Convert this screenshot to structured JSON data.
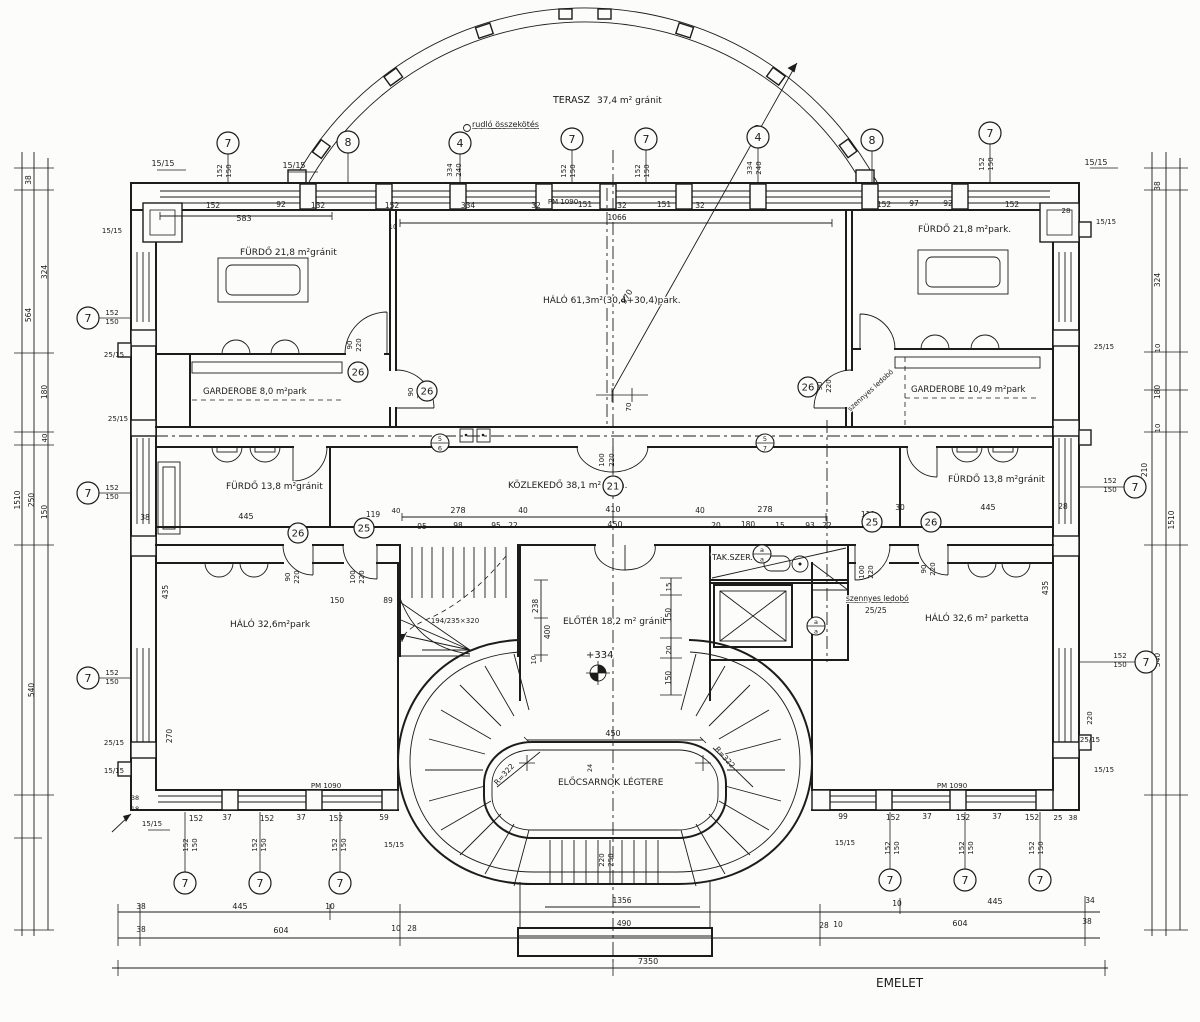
{
  "meta": {
    "sheet_label": "EMELET",
    "drawing_type": "floor plan"
  },
  "room_labels": [
    {
      "t": "TERASZ",
      "x": 553,
      "y": 103,
      "fs": 9.5
    },
    {
      "t": "37,4 m² gránit",
      "x": 597,
      "y": 103,
      "fs": 9
    },
    {
      "t": "FÜRDŐ  21,8 m²gránit",
      "x": 240,
      "y": 255,
      "fs": 9
    },
    {
      "t": "FÜRDŐ  21,8 m²park.",
      "x": 918,
      "y": 232,
      "fs": 9
    },
    {
      "t": "HÁLÓ  61,3m²(30,4+30,4)park.",
      "x": 543,
      "y": 303,
      "fs": 9
    },
    {
      "t": "GARDEROBE  8,0 m²park",
      "x": 203,
      "y": 394,
      "fs": 8.5
    },
    {
      "t": "GARDEROBE  10,49 m²park",
      "x": 911,
      "y": 392,
      "fs": 8.5
    },
    {
      "t": "FÜRDŐ  13,8 m²gránit",
      "x": 226,
      "y": 489,
      "fs": 9
    },
    {
      "t": "KÖZLEKEDŐ  38,1 m² grán.",
      "x": 508,
      "y": 488,
      "fs": 9
    },
    {
      "t": "FÜRDŐ  13,8 m²gránit",
      "x": 948,
      "y": 482,
      "fs": 9
    },
    {
      "t": "HÁLÓ  32,6m²park",
      "x": 230,
      "y": 627,
      "fs": 9
    },
    {
      "t": "ELŐTÉR  18,2 m² gránit",
      "x": 563,
      "y": 624,
      "fs": 9
    },
    {
      "t": "HÁLÓ  32,6 m² parketta",
      "x": 925,
      "y": 621,
      "fs": 9
    },
    {
      "t": "ELŐCSARNOK LÉGTERE",
      "x": 558,
      "y": 785,
      "fs": 9
    },
    {
      "t": "TAK.SZER.",
      "x": 712,
      "y": 560,
      "fs": 8
    },
    {
      "t": "EMELET",
      "x": 876,
      "y": 987,
      "fs": 12
    },
    {
      "t": "szennyes ledobó",
      "x": 846,
      "y": 601,
      "fs": 7.5,
      "u": 1
    },
    {
      "t": "25/25",
      "x": 865,
      "y": 613,
      "fs": 7.5
    },
    {
      "t": "rudló összekötés",
      "x": 472,
      "y": 127,
      "fs": 8,
      "u": 1
    },
    {
      "t": "+334",
      "x": 586,
      "y": 658,
      "fs": 10
    },
    {
      "t": "szennyes ledobó",
      "x": 872,
      "y": 392,
      "fs": 7,
      "r": -42,
      "a": "middle"
    }
  ],
  "dimensions": [
    {
      "t": "15/15",
      "x": 163,
      "y": 166
    },
    {
      "t": "15/15",
      "x": 294,
      "y": 168
    },
    {
      "t": "15/15",
      "x": 1096,
      "y": 165
    },
    {
      "t": "152",
      "x": 222,
      "y": 171,
      "r": -90,
      "fs": 7
    },
    {
      "t": "150",
      "x": 231,
      "y": 171,
      "r": -90,
      "fs": 7
    },
    {
      "t": "334",
      "x": 452,
      "y": 170,
      "r": -90,
      "fs": 7
    },
    {
      "t": "240",
      "x": 461,
      "y": 170,
      "r": -90,
      "fs": 7
    },
    {
      "t": "152",
      "x": 566,
      "y": 171,
      "r": -90,
      "fs": 7
    },
    {
      "t": "150",
      "x": 575,
      "y": 171,
      "r": -90,
      "fs": 7
    },
    {
      "t": "152",
      "x": 640,
      "y": 171,
      "r": -90,
      "fs": 7
    },
    {
      "t": "150",
      "x": 649,
      "y": 171,
      "r": -90,
      "fs": 7
    },
    {
      "t": "334",
      "x": 752,
      "y": 168,
      "r": -90,
      "fs": 7
    },
    {
      "t": "240",
      "x": 761,
      "y": 168,
      "r": -90,
      "fs": 7
    },
    {
      "t": "152",
      "x": 984,
      "y": 164,
      "r": -90,
      "fs": 7
    },
    {
      "t": "150",
      "x": 993,
      "y": 164,
      "r": -90,
      "fs": 7
    },
    {
      "t": "152",
      "x": 213,
      "y": 208,
      "fs": 7.5
    },
    {
      "t": "92",
      "x": 281,
      "y": 207,
      "fs": 7.5
    },
    {
      "t": "132",
      "x": 318,
      "y": 208,
      "fs": 7.5
    },
    {
      "t": "152",
      "x": 392,
      "y": 208,
      "fs": 7.5
    },
    {
      "t": "334",
      "x": 468,
      "y": 208,
      "fs": 7.5
    },
    {
      "t": "32",
      "x": 536,
      "y": 208,
      "fs": 7.5
    },
    {
      "t": "PM 1090",
      "x": 563,
      "y": 204,
      "fs": 7
    },
    {
      "t": "151",
      "x": 585,
      "y": 207,
      "fs": 7.5
    },
    {
      "t": "32",
      "x": 622,
      "y": 208,
      "fs": 7.5
    },
    {
      "t": "151",
      "x": 664,
      "y": 207,
      "fs": 7.5
    },
    {
      "t": "32",
      "x": 700,
      "y": 208,
      "fs": 7.5
    },
    {
      "t": "152",
      "x": 884,
      "y": 207,
      "fs": 7.5
    },
    {
      "t": "97",
      "x": 914,
      "y": 206,
      "fs": 7.5
    },
    {
      "t": "92",
      "x": 948,
      "y": 206,
      "fs": 7.5
    },
    {
      "t": "152",
      "x": 1012,
      "y": 207,
      "fs": 7.5
    },
    {
      "t": "28",
      "x": 1066,
      "y": 213,
      "fs": 7
    },
    {
      "t": "583",
      "x": 244,
      "y": 221
    },
    {
      "t": "10",
      "x": 393,
      "y": 229,
      "fs": 7
    },
    {
      "t": "1066",
      "x": 617,
      "y": 220,
      "fs": 7.5
    },
    {
      "t": "970",
      "x": 629,
      "y": 298,
      "r": -60
    },
    {
      "t": "70",
      "x": 631,
      "y": 407,
      "r": -90,
      "fs": 7
    },
    {
      "t": "90",
      "x": 352,
      "y": 345,
      "r": -90,
      "fs": 7
    },
    {
      "t": "220",
      "x": 361,
      "y": 345,
      "r": -90,
      "fs": 7
    },
    {
      "t": "90",
      "x": 413,
      "y": 392,
      "r": -90,
      "fs": 7
    },
    {
      "t": "220",
      "x": 422,
      "y": 392,
      "r": -90,
      "fs": 7
    },
    {
      "t": "90",
      "x": 822,
      "y": 386,
      "r": -90,
      "fs": 7
    },
    {
      "t": "220",
      "x": 831,
      "y": 386,
      "r": -90,
      "fs": 7
    },
    {
      "t": "100",
      "x": 604,
      "y": 460,
      "r": -90,
      "fs": 7
    },
    {
      "t": "220",
      "x": 614,
      "y": 460,
      "r": -90,
      "fs": 7
    },
    {
      "t": "278",
      "x": 458,
      "y": 513
    },
    {
      "t": "40",
      "x": 523,
      "y": 513,
      "fs": 7.5
    },
    {
      "t": "410",
      "x": 613,
      "y": 512
    },
    {
      "t": "40",
      "x": 700,
      "y": 513,
      "fs": 7.5
    },
    {
      "t": "278",
      "x": 765,
      "y": 512
    },
    {
      "t": "95",
      "x": 422,
      "y": 529,
      "fs": 7.5
    },
    {
      "t": "98",
      "x": 458,
      "y": 528,
      "fs": 7.5
    },
    {
      "t": "95",
      "x": 496,
      "y": 528,
      "fs": 7.5
    },
    {
      "t": "22",
      "x": 513,
      "y": 528,
      "fs": 7.5
    },
    {
      "t": "450",
      "x": 615,
      "y": 527
    },
    {
      "t": "20",
      "x": 716,
      "y": 528,
      "fs": 7.5
    },
    {
      "t": "180",
      "x": 748,
      "y": 527,
      "fs": 7.5
    },
    {
      "t": "15",
      "x": 780,
      "y": 528,
      "fs": 7.5
    },
    {
      "t": "93",
      "x": 810,
      "y": 528,
      "fs": 7.5
    },
    {
      "t": "22",
      "x": 827,
      "y": 528,
      "fs": 7.5
    },
    {
      "t": "38",
      "x": 145,
      "y": 520,
      "fs": 7.5
    },
    {
      "t": "445",
      "x": 246,
      "y": 519
    },
    {
      "t": "119",
      "x": 373,
      "y": 517,
      "fs": 7.5
    },
    {
      "t": "40",
      "x": 396,
      "y": 513,
      "fs": 7
    },
    {
      "t": "30",
      "x": 900,
      "y": 510,
      "fs": 7.5
    },
    {
      "t": "445",
      "x": 988,
      "y": 510
    },
    {
      "t": "119",
      "x": 868,
      "y": 517,
      "fs": 7.5
    },
    {
      "t": "28",
      "x": 1063,
      "y": 509,
      "fs": 7.5
    },
    {
      "t": "152",
      "x": 112,
      "y": 315,
      "fs": 7
    },
    {
      "t": "150",
      "x": 112,
      "y": 324,
      "fs": 7
    },
    {
      "t": "152",
      "x": 112,
      "y": 490,
      "fs": 7
    },
    {
      "t": "150",
      "x": 112,
      "y": 499,
      "fs": 7
    },
    {
      "t": "152",
      "x": 112,
      "y": 675,
      "fs": 7
    },
    {
      "t": "150",
      "x": 112,
      "y": 684,
      "fs": 7
    },
    {
      "t": "152",
      "x": 1110,
      "y": 483,
      "fs": 7
    },
    {
      "t": "150",
      "x": 1110,
      "y": 492,
      "fs": 7
    },
    {
      "t": "152",
      "x": 1120,
      "y": 658,
      "fs": 7
    },
    {
      "t": "150",
      "x": 1120,
      "y": 667,
      "fs": 7
    },
    {
      "t": "15/15",
      "x": 112,
      "y": 233,
      "fs": 7
    },
    {
      "t": "25/15",
      "x": 114,
      "y": 357,
      "fs": 7
    },
    {
      "t": "25/15",
      "x": 118,
      "y": 421,
      "fs": 7
    },
    {
      "t": "25/15",
      "x": 114,
      "y": 745,
      "fs": 7
    },
    {
      "t": "15/15",
      "x": 114,
      "y": 773,
      "fs": 7
    },
    {
      "t": "15/15",
      "x": 1106,
      "y": 224,
      "fs": 7
    },
    {
      "t": "25/15",
      "x": 1104,
      "y": 349,
      "fs": 7
    },
    {
      "t": "25/15",
      "x": 1090,
      "y": 742,
      "fs": 7
    },
    {
      "t": "220",
      "x": 1092,
      "y": 718,
      "r": -90,
      "fs": 7
    },
    {
      "t": "15/15",
      "x": 1104,
      "y": 772,
      "fs": 7
    },
    {
      "t": "38",
      "x": 31,
      "y": 180,
      "r": -90,
      "fs": 7.5
    },
    {
      "t": "324",
      "x": 47,
      "y": 272,
      "r": -90,
      "fs": 7.5
    },
    {
      "t": "564",
      "x": 31,
      "y": 315,
      "r": -90,
      "fs": 7.5
    },
    {
      "t": "180",
      "x": 47,
      "y": 392,
      "r": -90,
      "fs": 7.5
    },
    {
      "t": "40",
      "x": 47,
      "y": 438,
      "r": -90,
      "fs": 7
    },
    {
      "t": "1510",
      "x": 20,
      "y": 500,
      "r": -90,
      "fs": 7.5
    },
    {
      "t": "250",
      "x": 34,
      "y": 500,
      "r": -90,
      "fs": 7.5
    },
    {
      "t": "150",
      "x": 47,
      "y": 512,
      "r": -90,
      "fs": 7.5
    },
    {
      "t": "540",
      "x": 34,
      "y": 690,
      "r": -90,
      "fs": 7.5
    },
    {
      "t": "38",
      "x": 1160,
      "y": 186,
      "r": -90,
      "fs": 7.5
    },
    {
      "t": "324",
      "x": 1160,
      "y": 280,
      "r": -90,
      "fs": 7.5
    },
    {
      "t": "10",
      "x": 1160,
      "y": 348,
      "r": -90,
      "fs": 7
    },
    {
      "t": "180",
      "x": 1160,
      "y": 392,
      "r": -90,
      "fs": 7.5
    },
    {
      "t": "10",
      "x": 1160,
      "y": 428,
      "r": -90,
      "fs": 7
    },
    {
      "t": "210",
      "x": 1147,
      "y": 470,
      "r": -90,
      "fs": 7.5
    },
    {
      "t": "1510",
      "x": 1174,
      "y": 520,
      "r": -90,
      "fs": 7.5
    },
    {
      "t": "540",
      "x": 1160,
      "y": 660,
      "r": -90,
      "fs": 7.5
    },
    {
      "t": "435",
      "x": 168,
      "y": 592,
      "r": -90,
      "fs": 7.5
    },
    {
      "t": "270",
      "x": 172,
      "y": 736,
      "r": -90,
      "fs": 7.5
    },
    {
      "t": "435",
      "x": 1048,
      "y": 588,
      "r": -90,
      "fs": 7.5
    },
    {
      "t": "90",
      "x": 290,
      "y": 577,
      "r": -90,
      "fs": 7
    },
    {
      "t": "220",
      "x": 299,
      "y": 577,
      "r": -90,
      "fs": 7
    },
    {
      "t": "100",
      "x": 355,
      "y": 577,
      "r": -90,
      "fs": 7
    },
    {
      "t": "220",
      "x": 364,
      "y": 577,
      "r": -90,
      "fs": 7
    },
    {
      "t": "100",
      "x": 864,
      "y": 572,
      "r": -90,
      "fs": 7
    },
    {
      "t": "220",
      "x": 873,
      "y": 572,
      "r": -90,
      "fs": 7
    },
    {
      "t": "90",
      "x": 926,
      "y": 569,
      "r": -90,
      "fs": 7
    },
    {
      "t": "220",
      "x": 935,
      "y": 569,
      "r": -90,
      "fs": 7
    },
    {
      "t": "150",
      "x": 337,
      "y": 603,
      "fs": 7.5
    },
    {
      "t": "89",
      "x": 388,
      "y": 603,
      "fs": 7.5
    },
    {
      "t": "238",
      "x": 538,
      "y": 606,
      "r": -90,
      "fs": 7.5
    },
    {
      "t": "400",
      "x": 550,
      "y": 632,
      "r": -90,
      "fs": 7.5
    },
    {
      "t": "10",
      "x": 536,
      "y": 660,
      "r": -90,
      "fs": 7
    },
    {
      "t": "15",
      "x": 671,
      "y": 587,
      "r": -90,
      "fs": 7
    },
    {
      "t": "150",
      "x": 671,
      "y": 615,
      "r": -90,
      "fs": 7.5
    },
    {
      "t": "20",
      "x": 671,
      "y": 650,
      "r": -90,
      "fs": 7
    },
    {
      "t": "150",
      "x": 671,
      "y": 678,
      "r": -90,
      "fs": 7.5
    },
    {
      "t": "194/235×320",
      "x": 455,
      "y": 623,
      "fs": 7
    },
    {
      "t": "450",
      "x": 613,
      "y": 736
    },
    {
      "t": "24",
      "x": 592,
      "y": 768,
      "r": -90,
      "fs": 6.5
    },
    {
      "t": "R=322",
      "x": 506,
      "y": 776,
      "r": -48,
      "fs": 7.5
    },
    {
      "t": "R=322",
      "x": 723,
      "y": 759,
      "r": 48,
      "fs": 7.5
    },
    {
      "t": "PM 1090",
      "x": 326,
      "y": 788,
      "fs": 7
    },
    {
      "t": "PM 1090",
      "x": 952,
      "y": 788,
      "fs": 7
    },
    {
      "t": "152",
      "x": 196,
      "y": 821,
      "fs": 7.5
    },
    {
      "t": "37",
      "x": 227,
      "y": 820,
      "fs": 7.5
    },
    {
      "t": "152",
      "x": 267,
      "y": 821,
      "fs": 7.5
    },
    {
      "t": "37",
      "x": 301,
      "y": 820,
      "fs": 7.5
    },
    {
      "t": "152",
      "x": 336,
      "y": 821,
      "fs": 7.5
    },
    {
      "t": "59",
      "x": 384,
      "y": 820,
      "fs": 7.5
    },
    {
      "t": "15/15",
      "x": 394,
      "y": 847,
      "fs": 7
    },
    {
      "t": "152",
      "x": 188,
      "y": 845,
      "r": -90,
      "fs": 7
    },
    {
      "t": "150",
      "x": 197,
      "y": 845,
      "r": -90,
      "fs": 7
    },
    {
      "t": "152",
      "x": 257,
      "y": 845,
      "r": -90,
      "fs": 7
    },
    {
      "t": "150",
      "x": 266,
      "y": 845,
      "r": -90,
      "fs": 7
    },
    {
      "t": "152",
      "x": 337,
      "y": 845,
      "r": -90,
      "fs": 7
    },
    {
      "t": "150",
      "x": 346,
      "y": 845,
      "r": -90,
      "fs": 7
    },
    {
      "t": "99",
      "x": 843,
      "y": 819,
      "fs": 7.5
    },
    {
      "t": "152",
      "x": 893,
      "y": 820,
      "fs": 7.5
    },
    {
      "t": "37",
      "x": 927,
      "y": 819,
      "fs": 7.5
    },
    {
      "t": "152",
      "x": 963,
      "y": 820,
      "fs": 7.5
    },
    {
      "t": "37",
      "x": 997,
      "y": 819,
      "fs": 7.5
    },
    {
      "t": "152",
      "x": 1032,
      "y": 820,
      "fs": 7.5
    },
    {
      "t": "25",
      "x": 1058,
      "y": 820,
      "fs": 7
    },
    {
      "t": "38",
      "x": 1073,
      "y": 820,
      "fs": 7
    },
    {
      "t": "15/15",
      "x": 845,
      "y": 845,
      "fs": 7
    },
    {
      "t": "152",
      "x": 890,
      "y": 848,
      "r": -90,
      "fs": 7
    },
    {
      "t": "150",
      "x": 899,
      "y": 848,
      "r": -90,
      "fs": 7
    },
    {
      "t": "152",
      "x": 964,
      "y": 848,
      "r": -90,
      "fs": 7
    },
    {
      "t": "150",
      "x": 973,
      "y": 848,
      "r": -90,
      "fs": 7
    },
    {
      "t": "152",
      "x": 1034,
      "y": 848,
      "r": -90,
      "fs": 7
    },
    {
      "t": "150",
      "x": 1043,
      "y": 848,
      "r": -90,
      "fs": 7
    },
    {
      "t": "38",
      "x": 135,
      "y": 800,
      "fs": 6.5
    },
    {
      "t": "18",
      "x": 135,
      "y": 811,
      "fs": 6.5
    },
    {
      "t": "15/15",
      "x": 152,
      "y": 826,
      "fs": 7
    },
    {
      "t": "38",
      "x": 141,
      "y": 909,
      "fs": 7.5
    },
    {
      "t": "445",
      "x": 240,
      "y": 909
    },
    {
      "t": "10",
      "x": 330,
      "y": 909,
      "fs": 7.5
    },
    {
      "t": "10",
      "x": 897,
      "y": 906,
      "fs": 7.5
    },
    {
      "t": "445",
      "x": 995,
      "y": 904
    },
    {
      "t": "34",
      "x": 1090,
      "y": 903,
      "fs": 7.5
    },
    {
      "t": "38",
      "x": 141,
      "y": 932,
      "fs": 7.5
    },
    {
      "t": "604",
      "x": 281,
      "y": 933
    },
    {
      "t": "10",
      "x": 396,
      "y": 931,
      "fs": 7.5
    },
    {
      "t": "28",
      "x": 412,
      "y": 931,
      "fs": 7.5
    },
    {
      "t": "28",
      "x": 824,
      "y": 928,
      "fs": 7.5
    },
    {
      "t": "10",
      "x": 838,
      "y": 927,
      "fs": 7.5
    },
    {
      "t": "604",
      "x": 960,
      "y": 926
    },
    {
      "t": "38",
      "x": 1087,
      "y": 924,
      "fs": 7.5
    },
    {
      "t": "1356",
      "x": 622,
      "y": 903,
      "fs": 7.5
    },
    {
      "t": "490",
      "x": 624,
      "y": 926,
      "fs": 7.5
    },
    {
      "t": "220",
      "x": 604,
      "y": 860,
      "r": -90,
      "fs": 7
    },
    {
      "t": "250",
      "x": 613,
      "y": 860,
      "r": -90,
      "fs": 7
    },
    {
      "t": "7350",
      "x": 648,
      "y": 964
    }
  ],
  "grid_bubbles": [
    {
      "n": "7",
      "x": 228,
      "y": 143,
      "lx": 228,
      "ly": 183
    },
    {
      "n": "8",
      "x": 348,
      "y": 142,
      "lx": 348,
      "ly": 183
    },
    {
      "n": "4",
      "x": 460,
      "y": 143,
      "lx": 460,
      "ly": 183
    },
    {
      "n": "7",
      "x": 572,
      "y": 139,
      "lx": 572,
      "ly": 183
    },
    {
      "n": "7",
      "x": 646,
      "y": 139,
      "lx": 646,
      "ly": 183
    },
    {
      "n": "4",
      "x": 758,
      "y": 137,
      "lx": 758,
      "ly": 183
    },
    {
      "n": "8",
      "x": 872,
      "y": 140,
      "lx": 872,
      "ly": 183
    },
    {
      "n": "7",
      "x": 990,
      "y": 133,
      "lx": 990,
      "ly": 183
    },
    {
      "n": "7",
      "x": 88,
      "y": 318,
      "lx": 131,
      "ly": 318
    },
    {
      "n": "7",
      "x": 88,
      "y": 493,
      "lx": 131,
      "ly": 493
    },
    {
      "n": "7",
      "x": 88,
      "y": 678,
      "lx": 131,
      "ly": 678
    },
    {
      "n": "7",
      "x": 1135,
      "y": 487,
      "lx": 1079,
      "ly": 487
    },
    {
      "n": "7",
      "x": 1146,
      "y": 662,
      "lx": 1079,
      "ly": 662
    },
    {
      "n": "7",
      "x": 185,
      "y": 883,
      "lx": 185,
      "ly": 812
    },
    {
      "n": "7",
      "x": 260,
      "y": 883,
      "lx": 260,
      "ly": 812
    },
    {
      "n": "7",
      "x": 340,
      "y": 883,
      "lx": 340,
      "ly": 812
    },
    {
      "n": "7",
      "x": 890,
      "y": 880,
      "lx": 890,
      "ly": 812
    },
    {
      "n": "7",
      "x": 965,
      "y": 880,
      "lx": 965,
      "ly": 812
    },
    {
      "n": "7",
      "x": 1040,
      "y": 880,
      "lx": 1040,
      "ly": 812
    }
  ],
  "ref_bubbles": [
    {
      "n": "26",
      "x": 358,
      "y": 372
    },
    {
      "n": "26",
      "x": 427,
      "y": 391
    },
    {
      "n": "26",
      "x": 808,
      "y": 387
    },
    {
      "n": "21",
      "x": 613,
      "y": 486
    },
    {
      "n": "26",
      "x": 298,
      "y": 533
    },
    {
      "n": "25",
      "x": 364,
      "y": 528
    },
    {
      "n": "25",
      "x": 872,
      "y": 522
    },
    {
      "n": "26",
      "x": 931,
      "y": 522
    }
  ],
  "split_bubbles": [
    {
      "a": "5",
      "b": "6",
      "x": 440,
      "y": 443
    },
    {
      "a": "5",
      "b": "7",
      "x": 765,
      "y": 443
    },
    {
      "a": "a",
      "b": "a",
      "x": 762,
      "y": 554
    },
    {
      "a": "a",
      "b": "a",
      "x": 816,
      "y": 626
    }
  ]
}
